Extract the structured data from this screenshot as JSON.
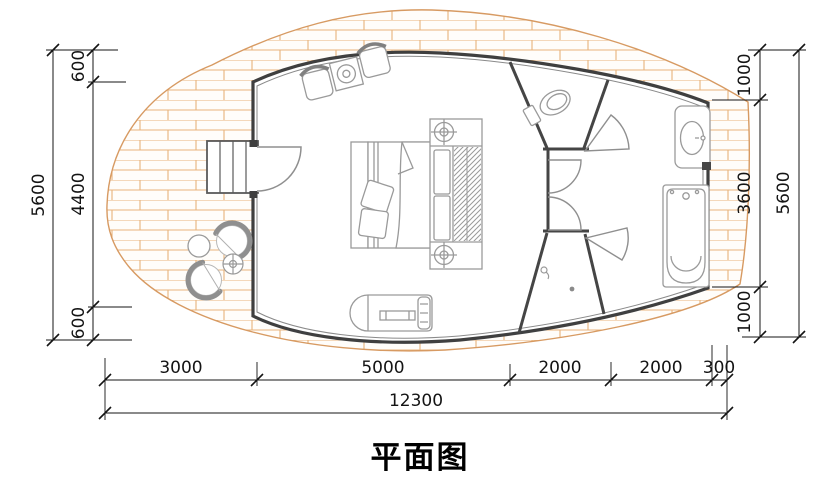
{
  "title": "平面图",
  "dims": {
    "left_outer": "5600",
    "left_chain": [
      "600",
      "4400",
      "600"
    ],
    "right_chain": [
      "1000",
      "3600",
      "1000"
    ],
    "right_outer": "5600",
    "bottom_chain": [
      "3000",
      "5000",
      "2000",
      "2000",
      "300"
    ],
    "bottom_total": "12300"
  },
  "colors": {
    "wall": "#3f3f3f",
    "wall_inner_line": "#8a8a8a",
    "brick_line": "#e8b47c",
    "deck_edge": "#d79a62",
    "furniture": "#9a9a9a",
    "dimension": "#141414"
  },
  "furniture_icons": [
    "entry-steps-icon",
    "entry-door-icon",
    "armchair-icon",
    "side-table-icon",
    "bed-icon",
    "pillow-icon",
    "wardrobe-icon",
    "ceiling-light-icon",
    "toilet-icon",
    "wash-basin-icon",
    "bathtub-icon",
    "shower-drain-icon",
    "tv-cabinet-icon",
    "outdoor-chair-icon",
    "outdoor-round-table-icon"
  ]
}
